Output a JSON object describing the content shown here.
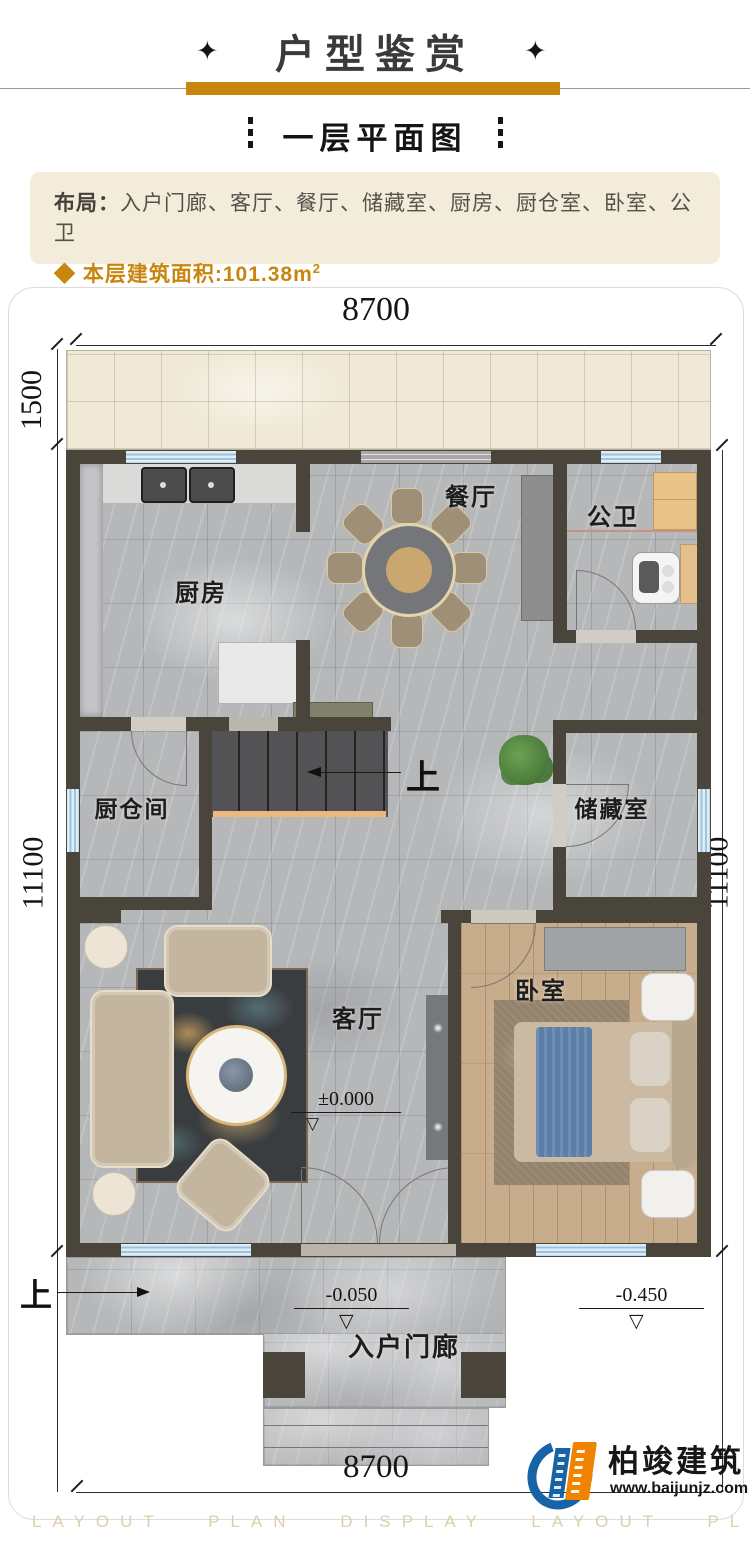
{
  "header": {
    "ornament": "✦",
    "title": "户型鉴赏"
  },
  "subtitle": "一层平面图",
  "info": {
    "layout_label": "布局：",
    "layout_value": "入户门廊、客厅、餐厅、储藏室、厨房、厨仓室、卧室、公卫",
    "bullet": "◆",
    "area_text": "本层建筑面积:101.38m",
    "area_sup": "2"
  },
  "plan": {
    "dims": {
      "top": "8700",
      "bottom": "8700",
      "terrace_depth": "1500",
      "left_height": "11100",
      "right_height": "11100"
    },
    "labels": {
      "kitchen": "厨房",
      "dining": "餐厅",
      "bathroom": "公卫",
      "pantry": "厨仓间",
      "storage": "储藏室",
      "living": "客厅",
      "bedroom": "卧室",
      "porch": "入户门廊"
    },
    "marks": {
      "stairs_up": "上",
      "porch_up": "上"
    },
    "elevations": {
      "living": "±0.000",
      "porch": "-0.050",
      "yard": "-0.450"
    },
    "icons": {
      "triangle_down": "▽"
    }
  },
  "footer": {
    "watermark": "LAYOUT PLAN DISPLAY LAYOUT PLAN DISPLAY",
    "brand": "柏竣建筑",
    "website": "www.baijunjz.com"
  },
  "colors": {
    "gold": "#c8860e",
    "cream": "#f3ecda",
    "wall": "#49453b",
    "window_blue": "#9fc3da",
    "logo_blue": "#1663a5",
    "logo_orange": "#f08300"
  }
}
